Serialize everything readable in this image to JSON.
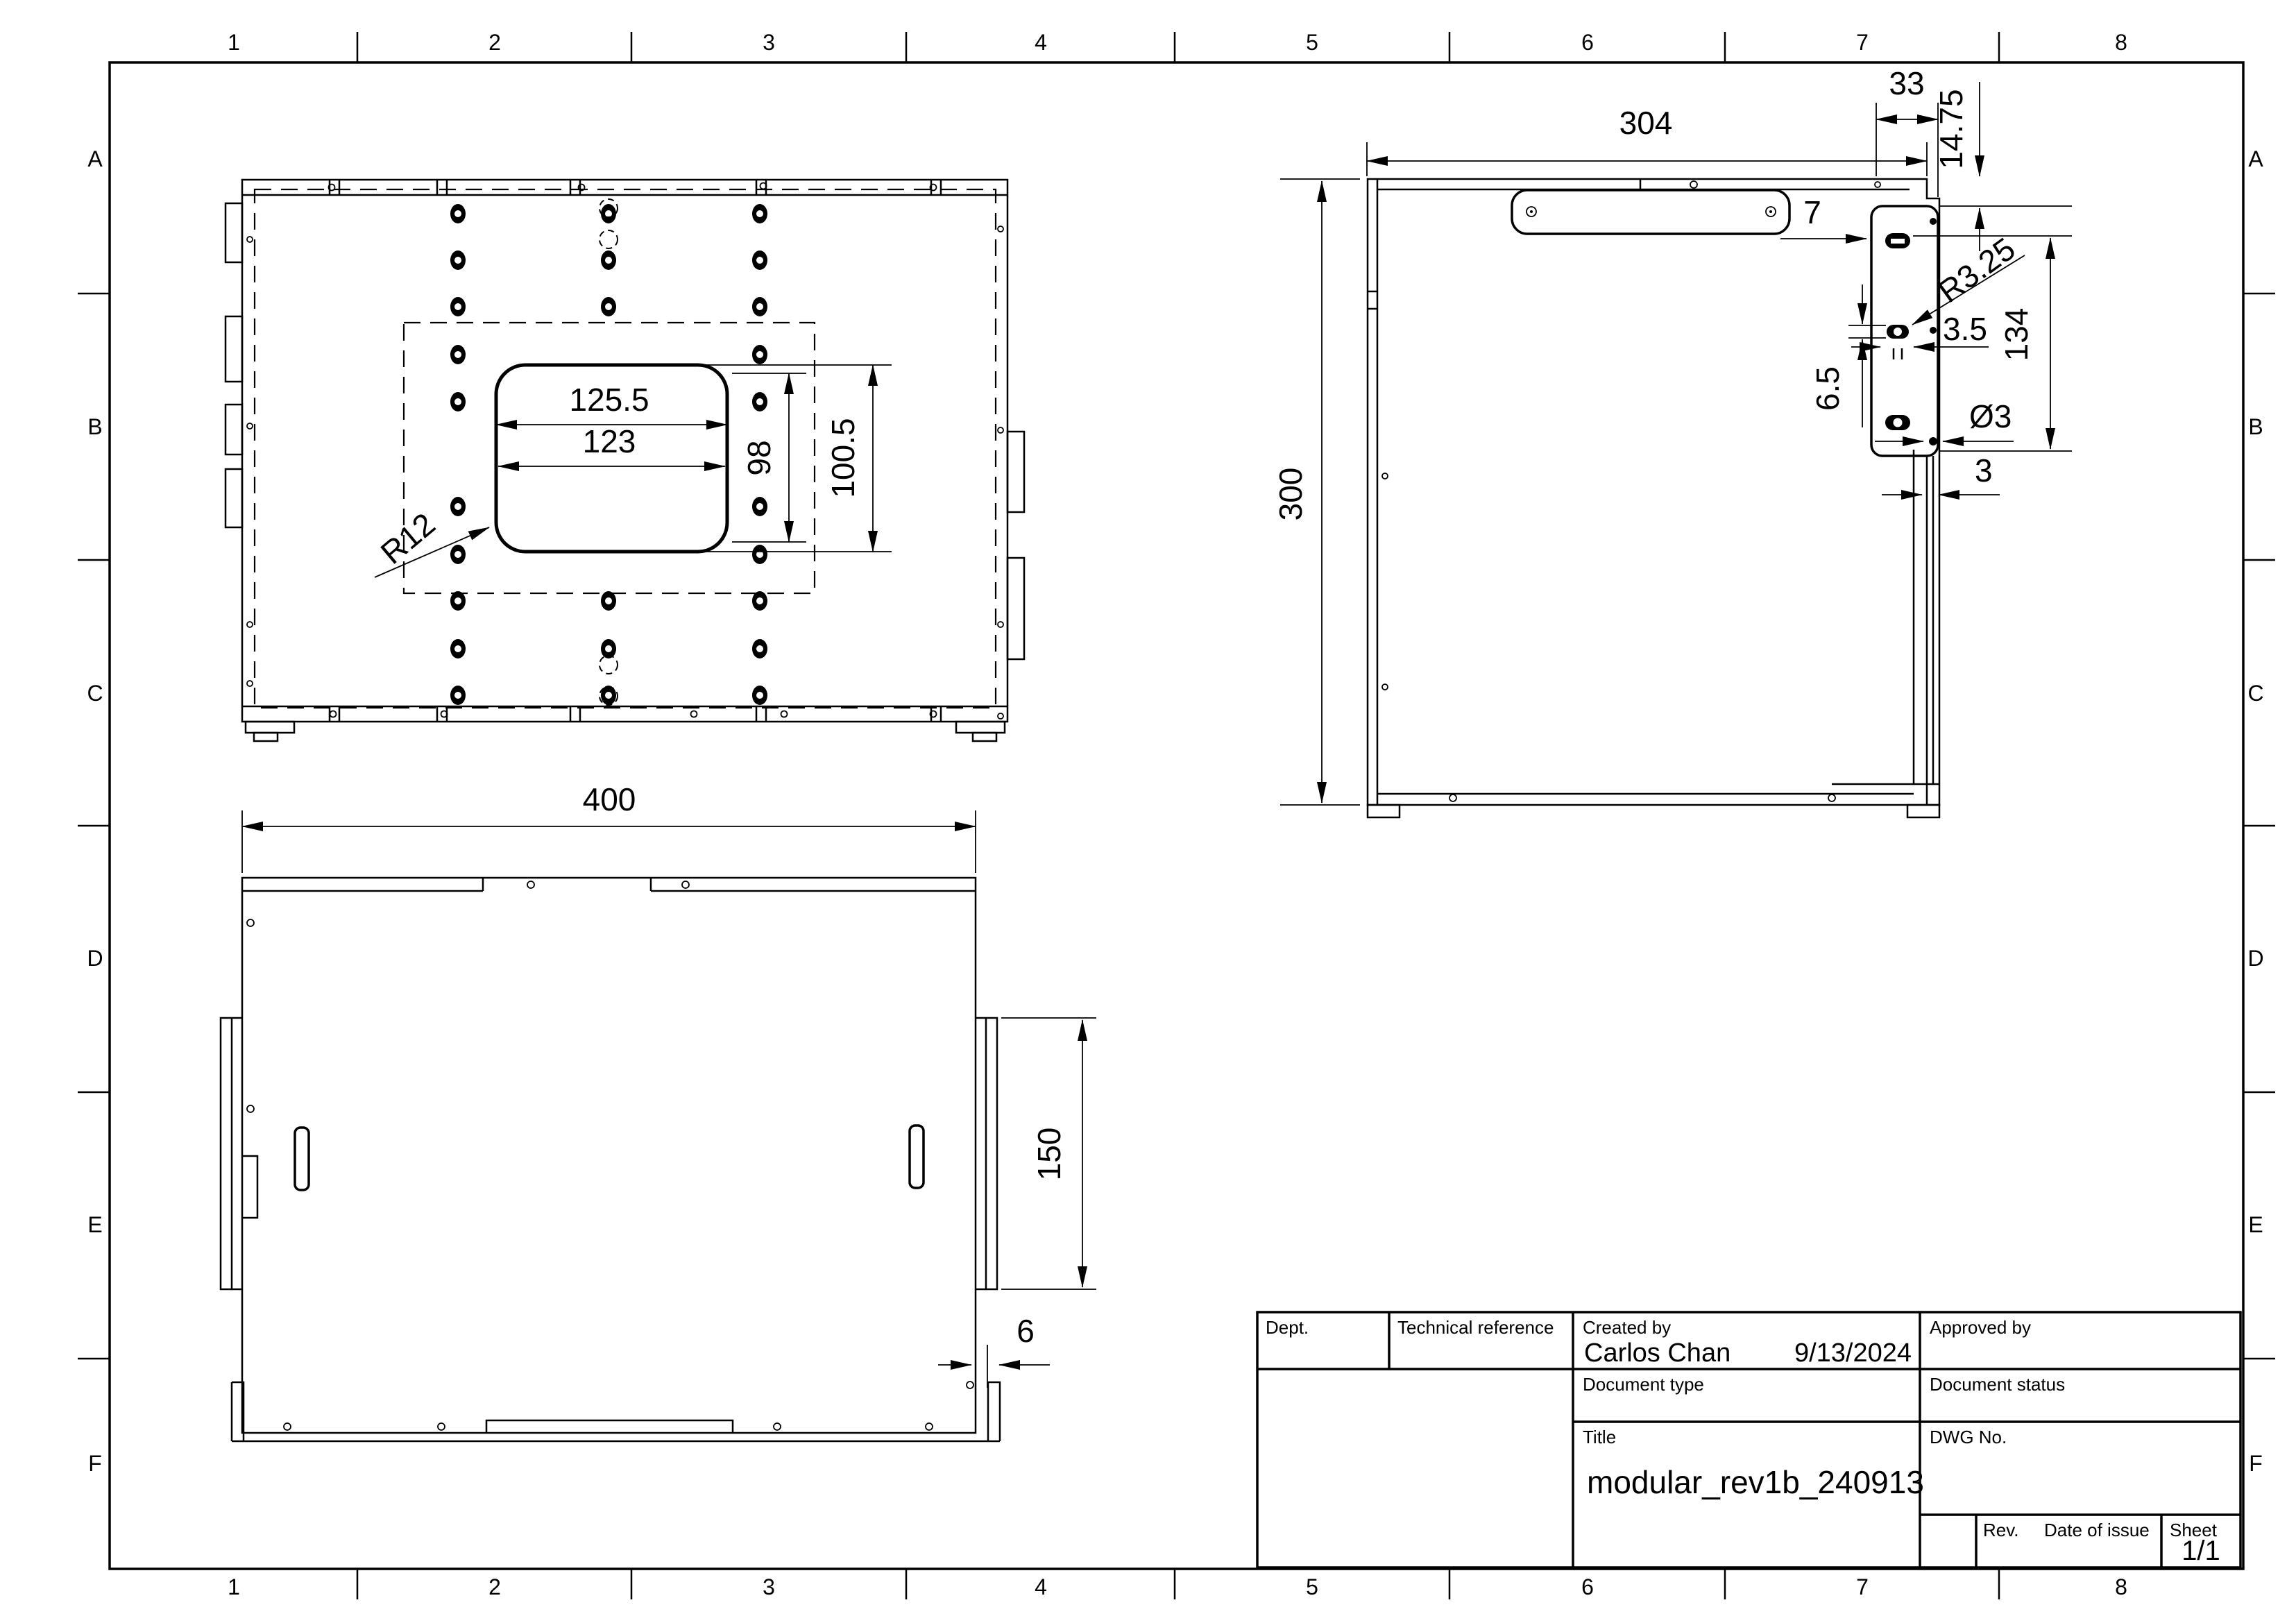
{
  "sheet": {
    "cols": [
      "1",
      "2",
      "3",
      "4",
      "5",
      "6",
      "7",
      "8"
    ],
    "rows": [
      "A",
      "B",
      "C",
      "D",
      "E",
      "F"
    ]
  },
  "title_block": {
    "dept_label": "Dept.",
    "tech_ref_label": "Technical reference",
    "created_by_label": "Created by",
    "approved_by_label": "Approved by",
    "doc_type_label": "Document type",
    "doc_status_label": "Document status",
    "title_label": "Title",
    "dwg_label": "DWG No.",
    "rev_label": "Rev.",
    "date_label": "Date of issue",
    "sheet_label": "Sheet",
    "created_by": "Carlos Chan",
    "created_date": "9/13/2024",
    "title": "modular_rev1b_240913",
    "sheet_num": "1/1"
  },
  "views": {
    "top": {
      "dims": {
        "w1": "125.5",
        "w2": "123",
        "h1": "98",
        "h2": "100.5",
        "r": "R12"
      }
    },
    "side": {
      "dims": {
        "w": "304",
        "h": "300",
        "off33": "33",
        "off1475": "14.75",
        "d7": "7",
        "r325": "R3.25",
        "d35": "3.5",
        "d65": "6.5",
        "d134": "134",
        "dia3": "Ø3",
        "d3": "3"
      }
    },
    "front": {
      "dims": {
        "w": "400",
        "h150": "150",
        "d6": "6"
      }
    }
  }
}
